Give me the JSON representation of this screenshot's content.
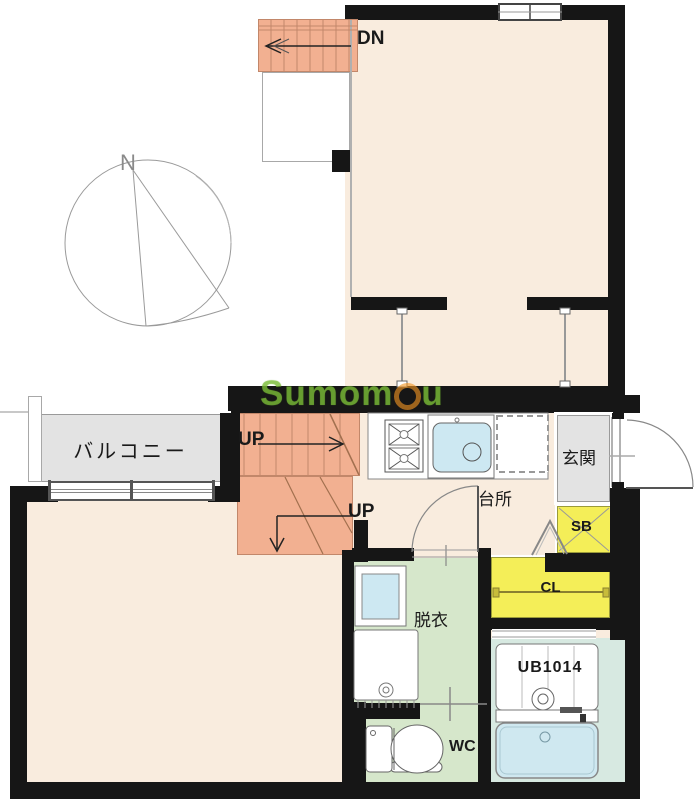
{
  "plan": {
    "compass": {
      "north_label": "N"
    },
    "floor2": {
      "stairs_down_label": "DN"
    },
    "floor1": {
      "balcony_label": "バルコニー",
      "stairs_up_label_upper": "UP",
      "stairs_up_label_lower": "UP",
      "kitchen_label": "台所",
      "entrance_label": "玄関",
      "shoe_box_label": "SB",
      "closet_label": "CL",
      "dressing_room_label": "脱衣",
      "toilet_label": "WC",
      "unit_bath_label": "UB1014"
    },
    "watermark": {
      "text_left": "Sumom",
      "text_right": "u"
    },
    "colors": {
      "wall": "#161616",
      "room_cream": "#f9ecde",
      "stairs_salmon": "#f2b091",
      "balcony_gray": "#e3e3e3",
      "storage_yellow": "#f4ee58",
      "wet_area_green": "#d6e7cb",
      "bath_teal": "#d7e9e1",
      "fixture_blue": "#cde8f2",
      "watermark_green": "#86c43f",
      "watermark_orange": "#f29422"
    }
  }
}
